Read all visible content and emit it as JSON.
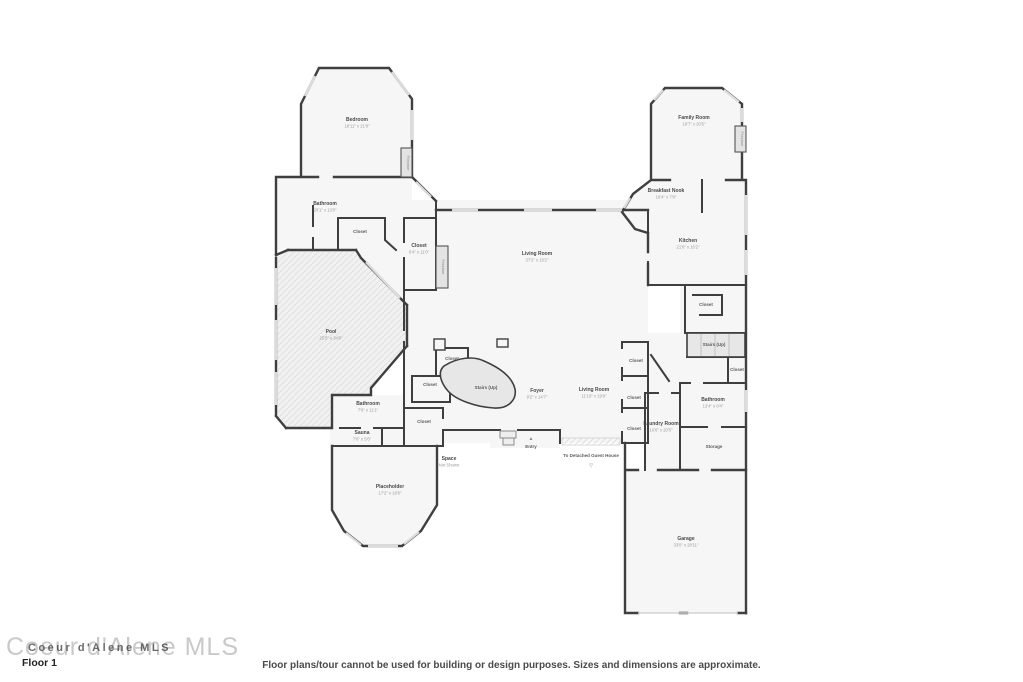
{
  "footer": {
    "watermark": "Coeur d'Alene MLS",
    "watermark_overlay": "Coeur d'Alene MLS",
    "floor_label": "Floor 1",
    "disclaimer": "Floor plans/tour cannot be used for building or design purposes. Sizes and dimensions are approximate."
  },
  "colors": {
    "wall": "#3f3f3f",
    "room_fill": "#f6f6f6",
    "pool_fill": "#f1f1f1",
    "window": "#dcdcdc",
    "stairs_fill": "#e7e7e7",
    "label": "#4a4a4a",
    "dims": "#9a9a9a"
  },
  "plan": {
    "labels": [
      {
        "name": "Bedroom",
        "dims": "18'11\" x 21'8\"",
        "x": 357,
        "y": 121
      },
      {
        "name": "Bathroom",
        "dims": "20'1\" x 13'0\"",
        "x": 325,
        "y": 205
      },
      {
        "name": "Closet",
        "x": 360,
        "y": 233
      },
      {
        "name": "Closet",
        "dims": "6'4\" x 11'0\"",
        "x": 419,
        "y": 247
      },
      {
        "name": "Pool",
        "dims": "25'5\" x 34'6\"",
        "x": 331,
        "y": 333
      },
      {
        "name": "Living Room",
        "dims": "37'2\" x 19'2\"",
        "x": 537,
        "y": 255
      },
      {
        "name": "Family Room",
        "dims": "19'7\" x 20'5\"",
        "x": 694,
        "y": 119
      },
      {
        "name": "Breakfast Nook",
        "dims": "16'4\" x 7'9\"",
        "x": 666,
        "y": 192
      },
      {
        "name": "Kitchen",
        "dims": "21'0\" x 16'2\"",
        "x": 688,
        "y": 242
      },
      {
        "name": "Closet",
        "x": 706,
        "y": 306
      },
      {
        "name": "Stairs (Up)",
        "x": 714,
        "y": 346
      },
      {
        "name": "Closet",
        "x": 737,
        "y": 371
      },
      {
        "name": "Bathroom",
        "dims": "13'4\" x 8'4\"",
        "x": 713,
        "y": 401
      },
      {
        "name": "Storage",
        "x": 714,
        "y": 448
      },
      {
        "name": "Laundry Room",
        "dims": "10'6\" x 20'5\"",
        "x": 661,
        "y": 425
      },
      {
        "name": "Living Room",
        "dims": "11'10\" x 19'9\"",
        "x": 594,
        "y": 391
      },
      {
        "name": "Closet",
        "x": 636,
        "y": 362
      },
      {
        "name": "Closet",
        "x": 634,
        "y": 399
      },
      {
        "name": "Closet",
        "x": 634,
        "y": 430
      },
      {
        "name": "Foyer",
        "dims": "9'2\" x 14'7\"",
        "x": 537,
        "y": 392
      },
      {
        "name": "Stairs (Up)",
        "x": 486,
        "y": 389
      },
      {
        "name": "Closet",
        "x": 452,
        "y": 360
      },
      {
        "name": "Closet",
        "x": 430,
        "y": 386
      },
      {
        "name": "Closet",
        "x": 424,
        "y": 423
      },
      {
        "name": "Bathroom",
        "dims": "7'6\" x 11'1\"",
        "x": 368,
        "y": 405
      },
      {
        "name": "Sauna",
        "dims": "7'6\" x 5'6\"",
        "x": 362,
        "y": 434
      },
      {
        "name": "Placeholder",
        "dims": "17'2\" x 18'6\"",
        "x": 390,
        "y": 488
      },
      {
        "name": "Space",
        "dims": "Not Shown",
        "x": 449,
        "y": 460
      },
      {
        "name": "Entry",
        "x": 531,
        "y": 448,
        "arrow": "▲",
        "ay": 440
      },
      {
        "name": "To Detached Guest House",
        "x": 591,
        "y": 457,
        "arrow": "▽",
        "ay": 467
      },
      {
        "name": "Garage",
        "dims": "33'0\" x 28'11\"",
        "x": 686,
        "y": 540
      },
      {
        "name": "Fireplace",
        "x": 407,
        "y": 163,
        "rot": 90,
        "fire": true
      },
      {
        "name": "Fireplace",
        "x": 442,
        "y": 267,
        "rot": 90,
        "fire": true
      },
      {
        "name": "Fireplace",
        "x": 741,
        "y": 139,
        "rot": 90,
        "fire": true
      }
    ]
  }
}
